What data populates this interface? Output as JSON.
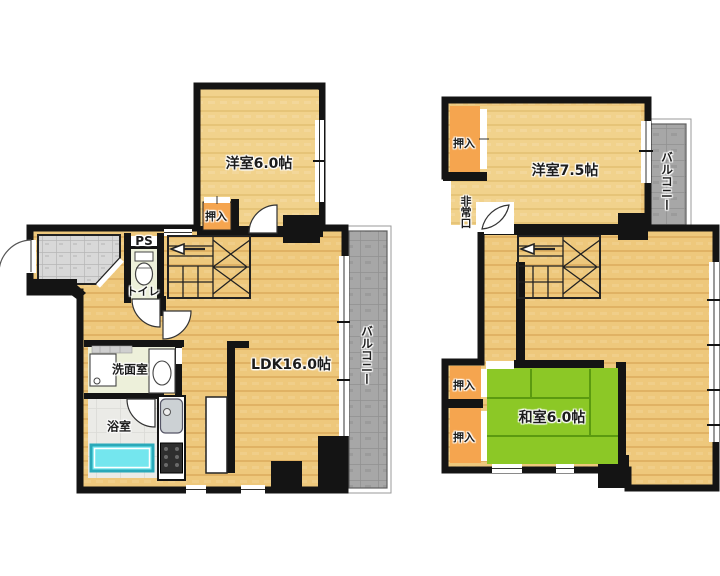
{
  "plan_left": {
    "labels": {
      "western_room": "洋室6.0帖",
      "closet": "押入",
      "pipe_space": "PS",
      "toilet": "トイレ",
      "washroom": "洗面室",
      "bathroom": "浴室",
      "ldk": "LDK16.0帖",
      "balcony": "バルコニー"
    }
  },
  "plan_right": {
    "labels": {
      "closet_top": "押入",
      "western_room": "洋室7.5帖",
      "balcony": "バルコニー",
      "emergency_exit": "非常口",
      "japanese_room": "和室6.0帖",
      "closet_upper": "押入",
      "closet_lower": "押入"
    }
  },
  "colors": {
    "wall": "#141414",
    "wood": "#eec87c",
    "plank": "#e0b264",
    "wood_light": "#f1d28c",
    "closet": "#f5a54f",
    "tatami": "#8cc826",
    "tatami_line": "#5b9a10",
    "balcony": "#a7a7a7",
    "entry_tile": "#d8d8d8",
    "wet_room": "#edf0da",
    "bath_tile": "#ebebe7",
    "bathtub": "#74e6ee",
    "bathtub_edge": "#2aa9b9"
  }
}
